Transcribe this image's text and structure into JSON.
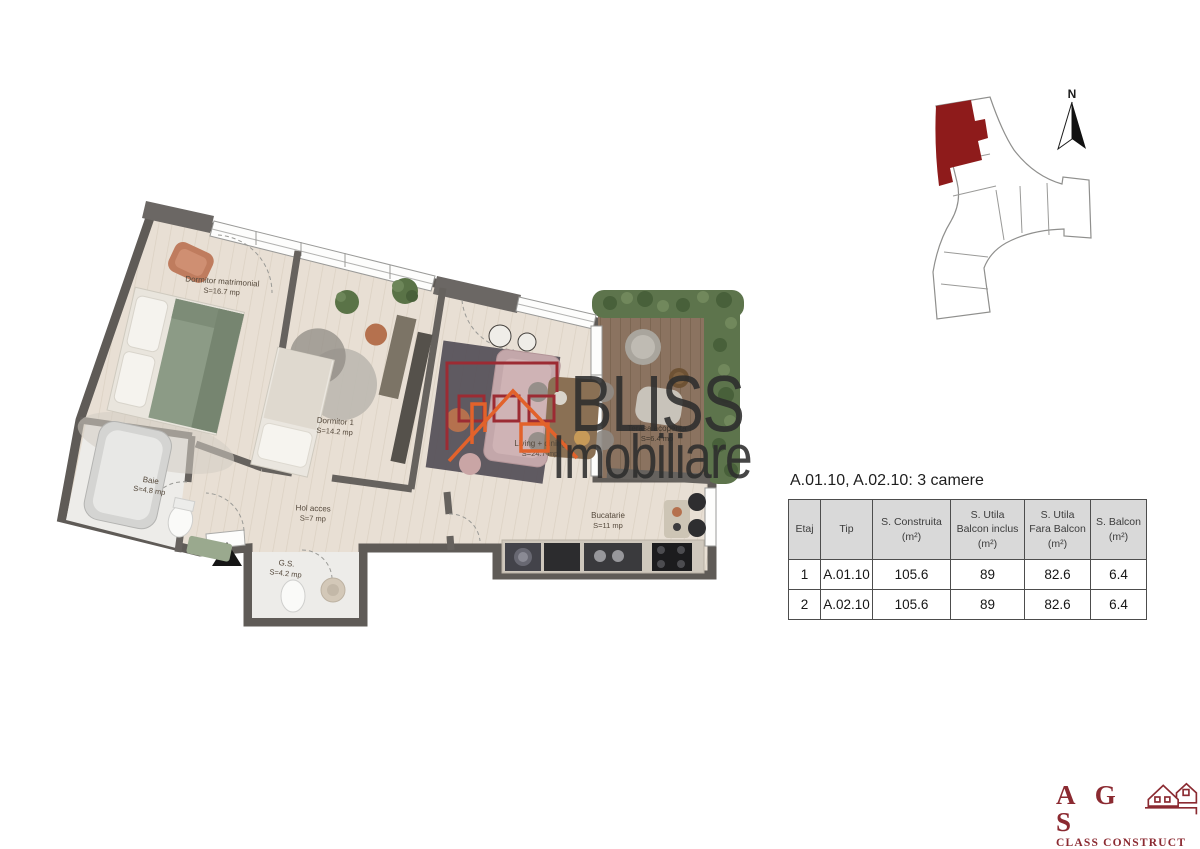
{
  "floor_plan": {
    "rooms": [
      {
        "name": "Dormitor matrimonial",
        "area": "S=16.7 mp"
      },
      {
        "name": "Dormitor 1",
        "area": "S=14.2 mp"
      },
      {
        "name": "Living + dining",
        "area": "S=24.7 mp"
      },
      {
        "name": "Terasa acoperita",
        "area": "S=6.4 mp"
      },
      {
        "name": "Baie",
        "area": "S=4.8 mp"
      },
      {
        "name": "Hol acces",
        "area": "S=7 mp"
      },
      {
        "name": "G.S.",
        "area": "S=4.2 mp"
      },
      {
        "name": "Bucatarie",
        "area": "S=11 mp"
      }
    ]
  },
  "site_plan": {
    "north_label": "N",
    "highlight_color": "#8e1b1b"
  },
  "unit_info": {
    "title": "A.01.10,  A.02.10: 3 camere",
    "table": {
      "headers": [
        "Etaj",
        "Tip",
        "S. Construita\n(m²)",
        "S. Utila\nBalcon inclus\n(m²)",
        "S. Utila\nFara Balcon\n(m²)",
        "S. Balcon\n(m²)"
      ],
      "rows": [
        [
          "1",
          "A.01.10",
          "105.6",
          "89",
          "82.6",
          "6.4"
        ],
        [
          "2",
          "A.02.10",
          "105.6",
          "89",
          "82.6",
          "6.4"
        ]
      ]
    }
  },
  "watermark": {
    "brand": "BLISS",
    "brand_line2": "Imobiliare"
  },
  "builder": {
    "initials": "A G S",
    "line2": "CLASS CONSTRUCT",
    "line3": "constructii & renovari"
  }
}
